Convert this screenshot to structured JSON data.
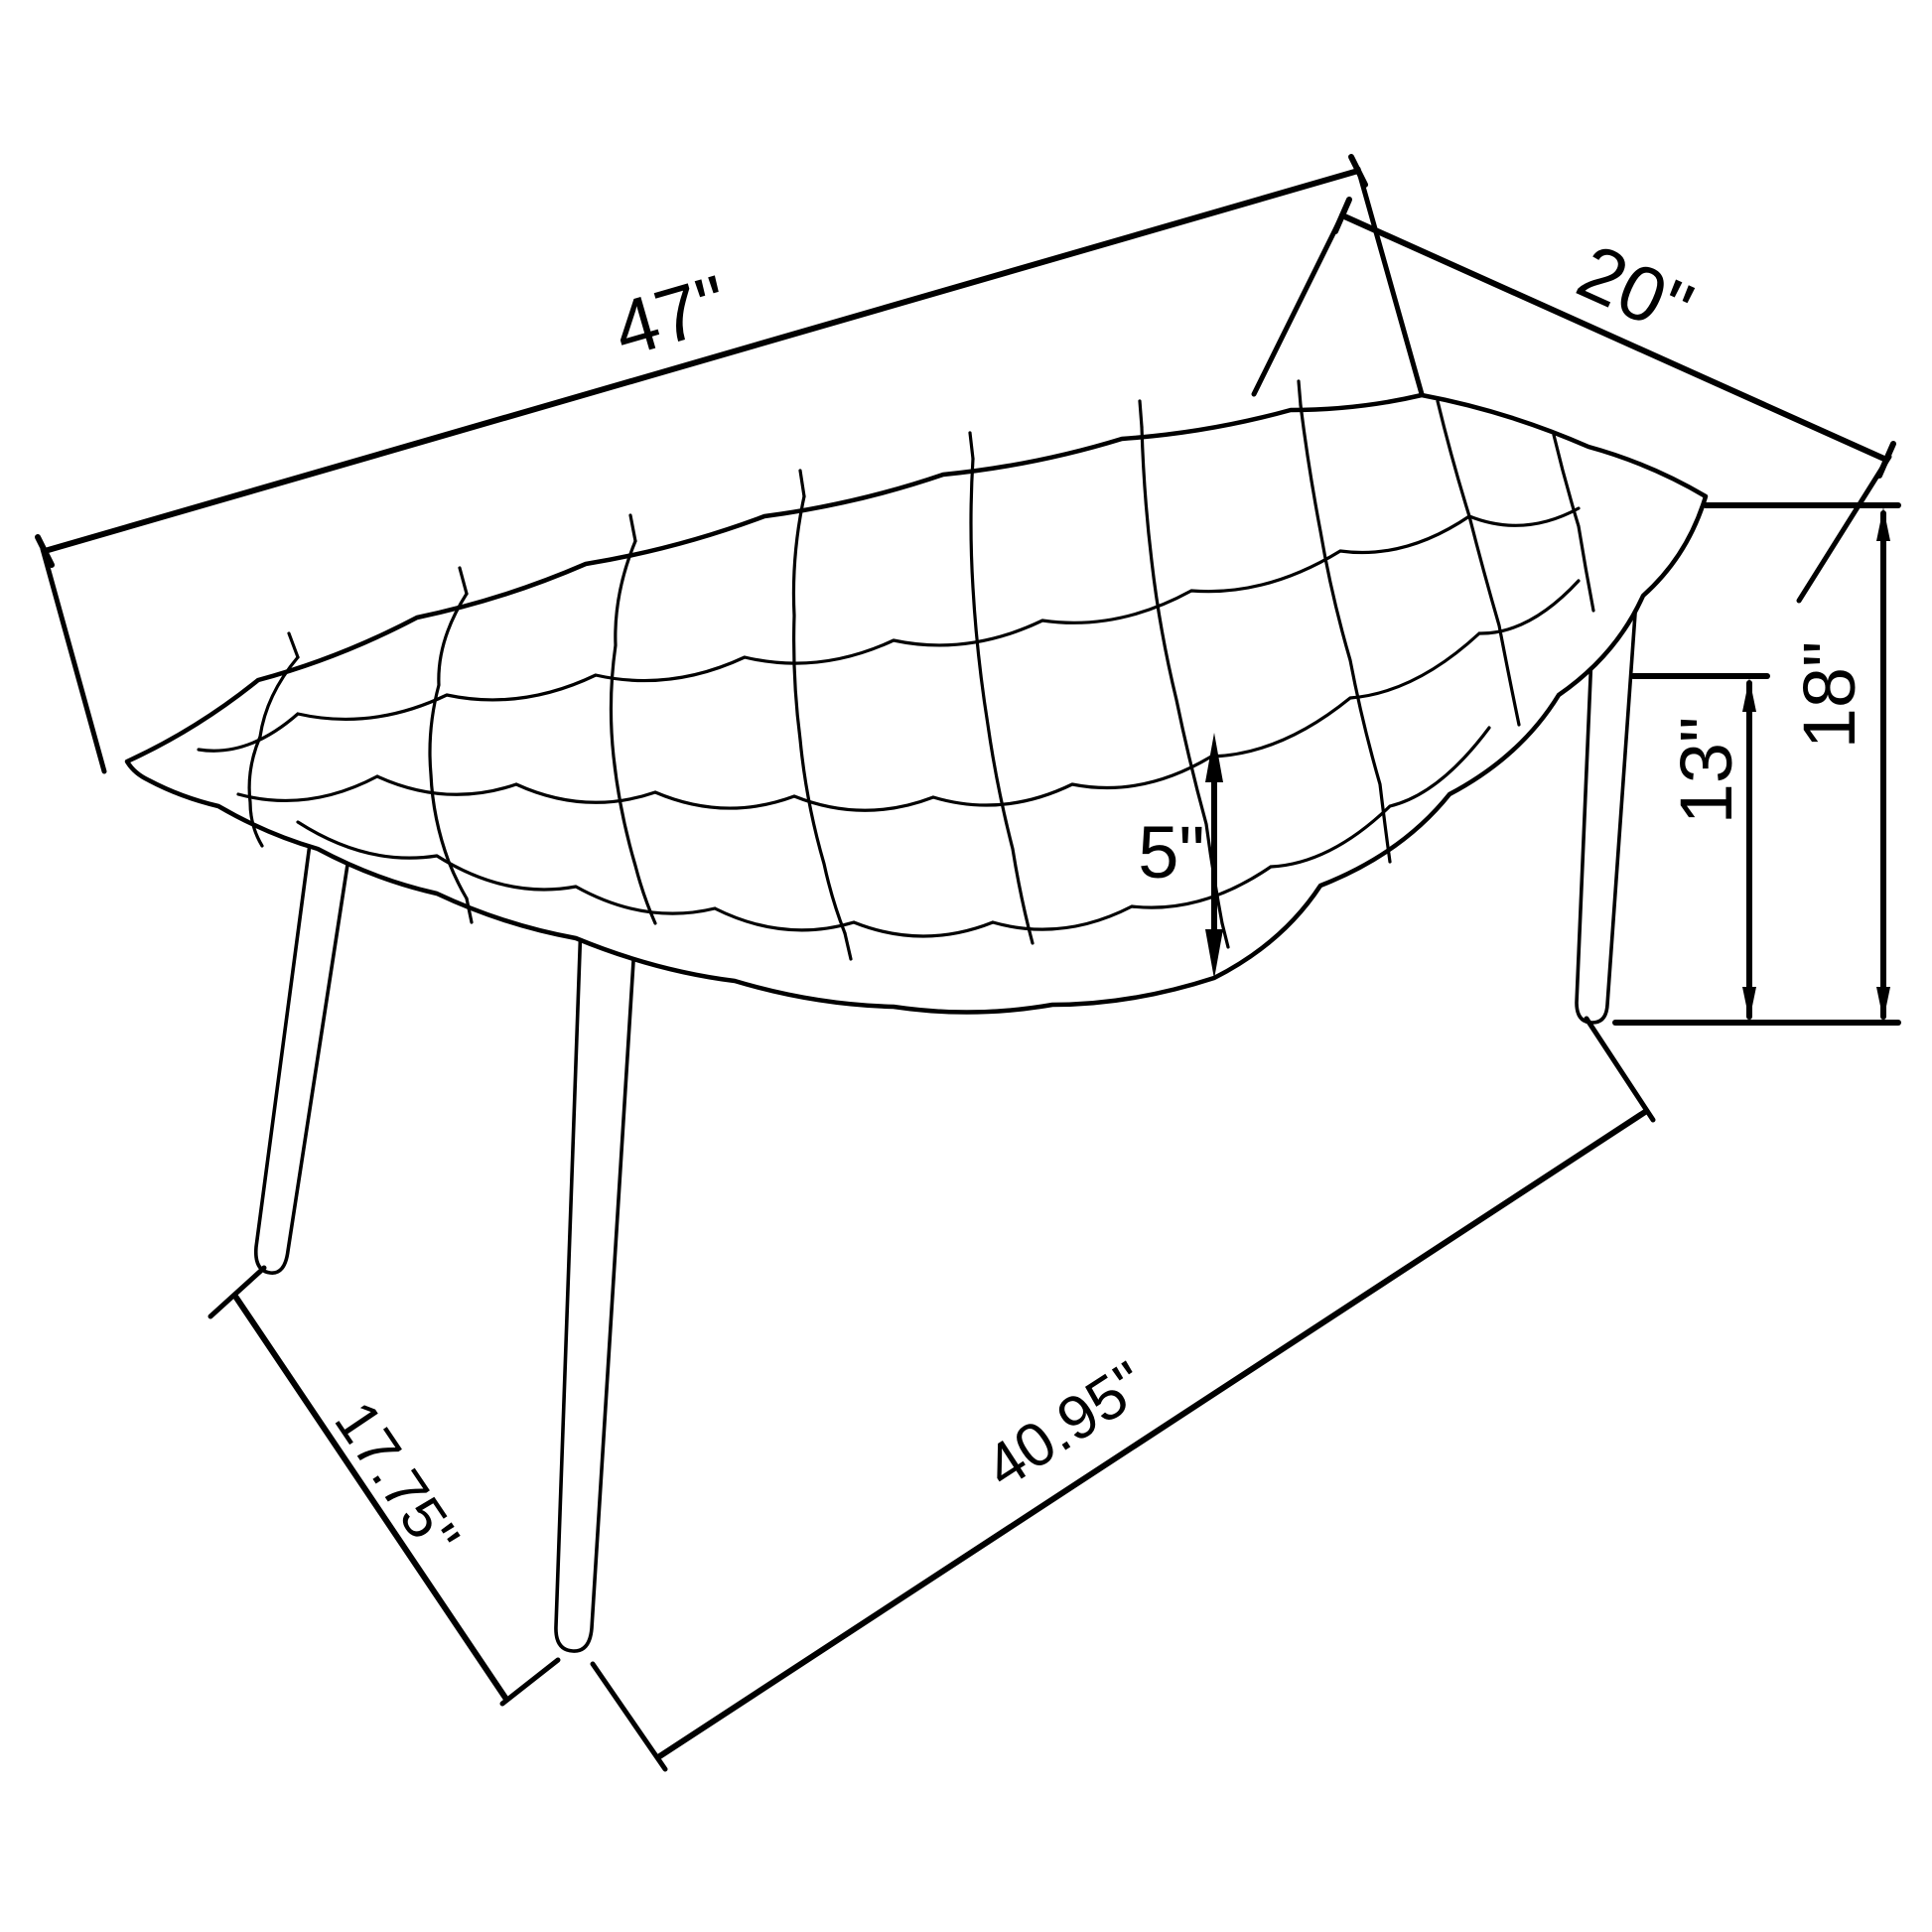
{
  "diagram": {
    "type": "furniture-dimension-drawing",
    "subject": "tufted bench with splayed legs, isometric line drawing",
    "colors": {
      "line": "#000000",
      "background": "#ffffff"
    },
    "dimensions": {
      "length": "47\"",
      "depth": "20\"",
      "overall_height": "18\"",
      "leg_height": "13\"",
      "cushion_thickness": "5\"",
      "footprint_depth": "17.75\"",
      "footprint_length": "40.95\""
    }
  }
}
